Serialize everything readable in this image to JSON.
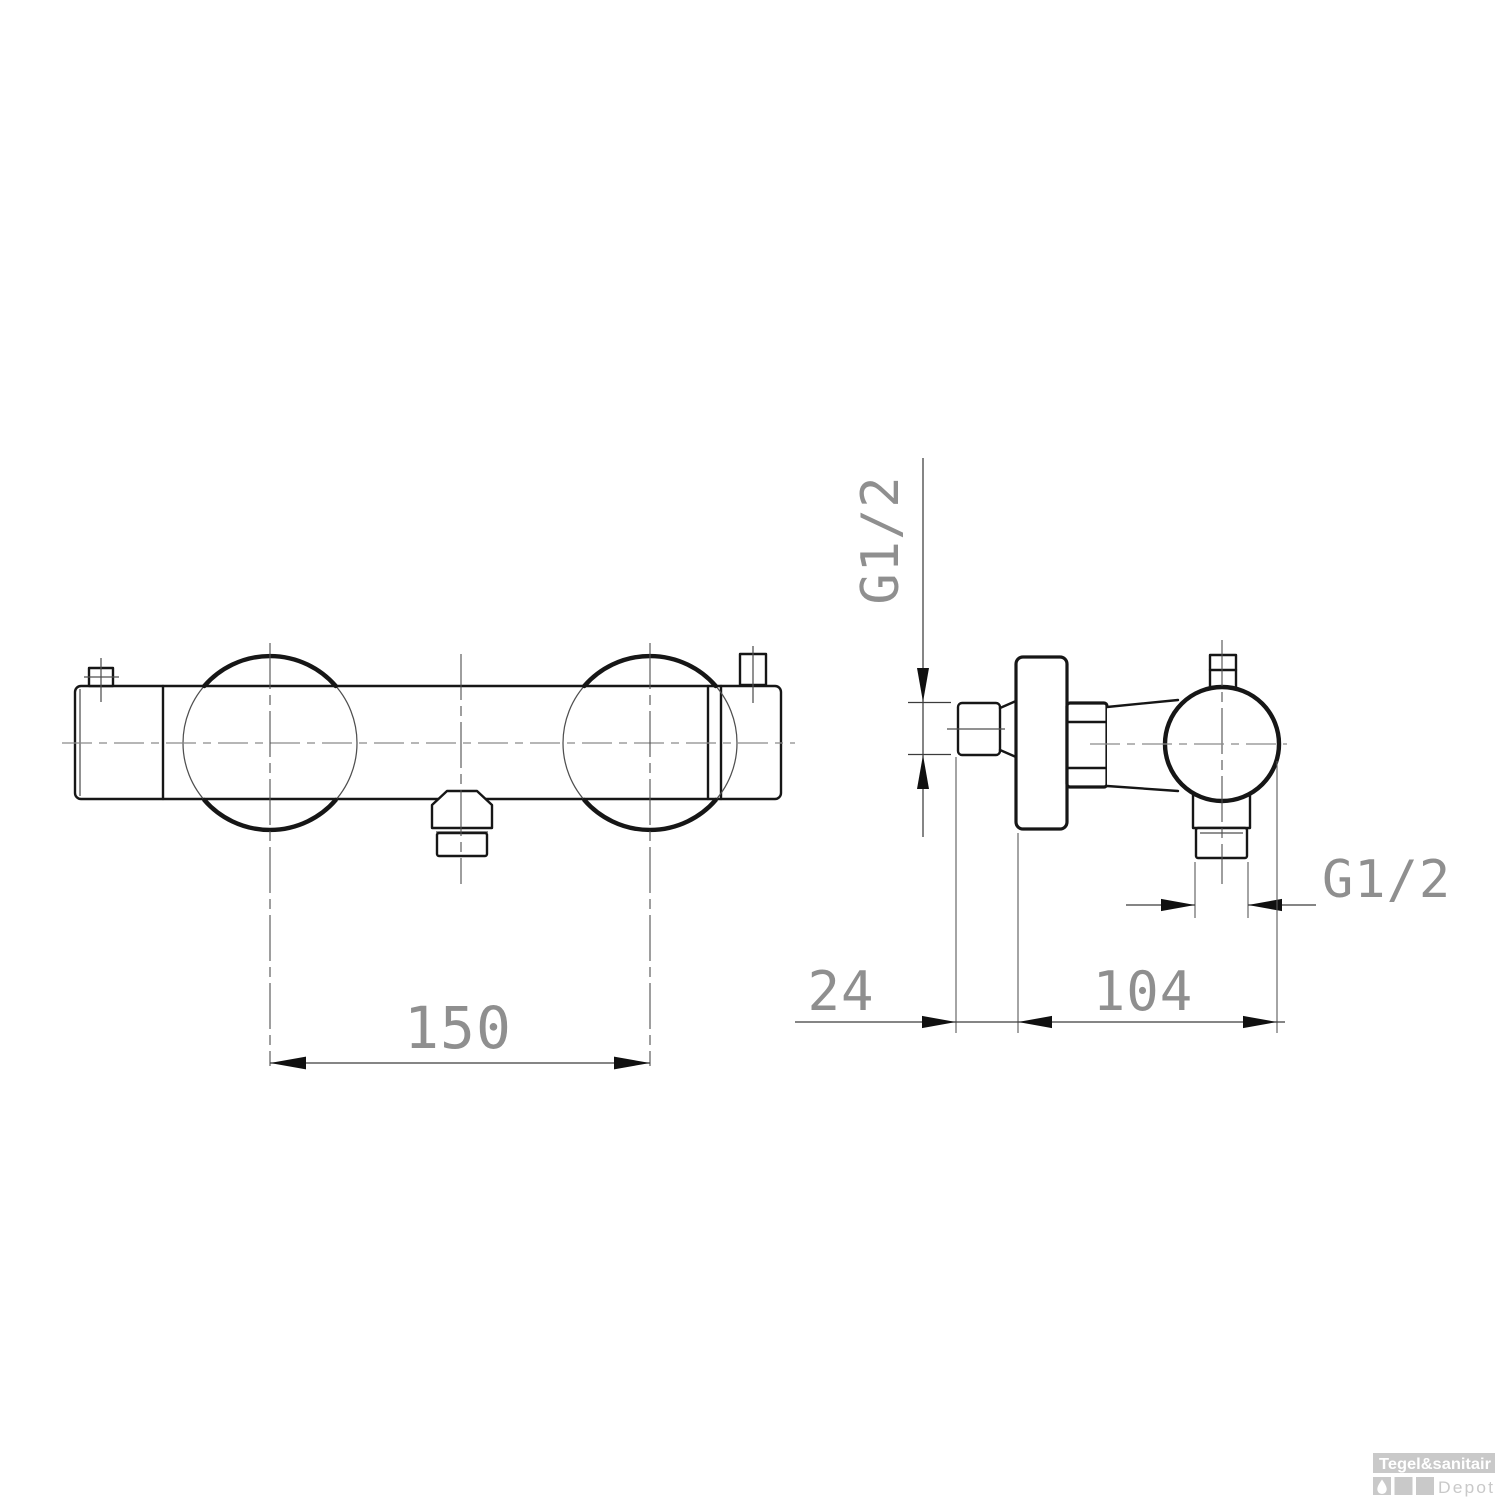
{
  "drawing": {
    "kind": "technical-dimensional-drawing",
    "subject": "wall-mounted thermostatic shower mixer, front view and side view"
  },
  "dimensions": {
    "front_center_distance": "150",
    "inlet_protrusion": "24",
    "wall_to_front": "104",
    "inlet_thread": "G1/2",
    "outlet_thread": "G1/2"
  },
  "watermark": {
    "brand": "Tegel&sanitair",
    "sub": "Depot"
  },
  "colors": {
    "line": "#161616",
    "thin": "#4f4f4f",
    "center": "#8a8a8a",
    "dim": "#3c3c3c",
    "dimtext": "#8f8f8f",
    "wm": "#c9c9c9",
    "background": "#ffffff"
  }
}
